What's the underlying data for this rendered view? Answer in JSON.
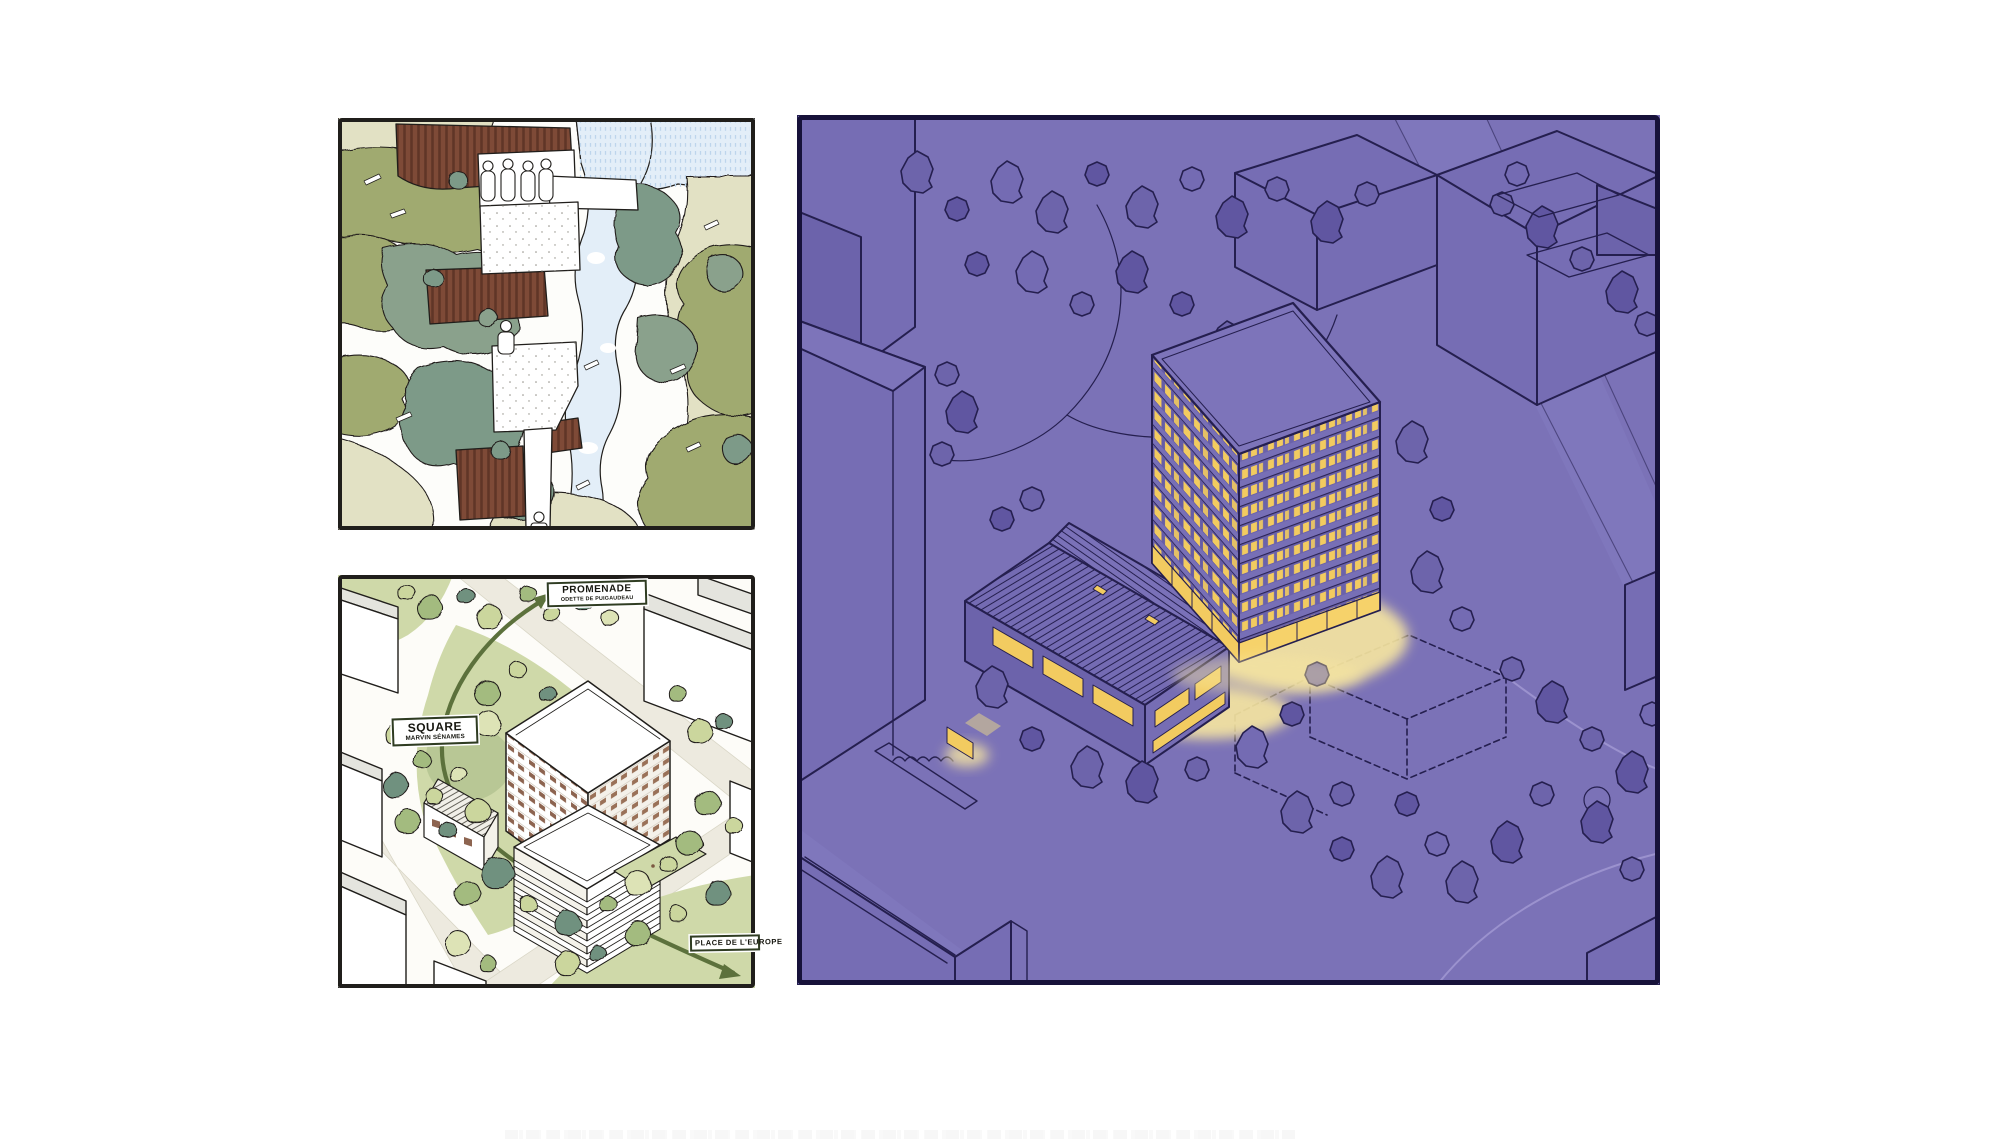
{
  "page": {
    "background": "#ffffff"
  },
  "site_axonometric": {
    "labels": {
      "promenade": {
        "title": "PROMENADE",
        "subtitle": "ODETTE DE PUIGAUDEAU"
      },
      "square": {
        "title": "SQUARE",
        "subtitle": "MARVIN SÉNAMES"
      },
      "place_de_europe": {
        "title": "PLACE DE L'EUROPE"
      }
    },
    "icons": [
      "route-arrow-icon"
    ]
  },
  "night_axonometric": {
    "highlight": "lit tower and gabled hall with window glow",
    "icons": [
      "dashed-future-volume"
    ]
  },
  "palette": {
    "page-bg": "#ffffff",
    "ink": "#201e1b",
    "night-ink": "#251f4f",
    "night-bg": "#7b72b7",
    "night-street": "#847bc1",
    "night-building": "#766db4",
    "night-building-dark": "#6c63ab",
    "night-roof": "#7d74ba",
    "night-tree": "#6d64ab",
    "night-tree-dark": "#6056a1",
    "window-lit": "#f2cb60",
    "window-glow": "#f8e7a0",
    "day-olive": "#a0aa70",
    "day-sage": "#8aa18c",
    "day-teal": "#7d9a88",
    "day-beige": "#e2e1c4",
    "day-blue": "#e3eef8",
    "day-blue-hatch": "#bdd5ec",
    "roof-brown": "#7e4a37",
    "roof-brown-dark": "#603527",
    "lawn": "#cfd9a9",
    "lawn-dark": "#b8c795",
    "tree-green": "#a3bb7f",
    "tree-green-light": "#cbd69d",
    "tree-green-dark": "#6f917f",
    "tree-green-pale": "#dde3b6",
    "street-cream": "#edeadf",
    "building-grey": "#e4e4de",
    "tower-band": "#8d6450",
    "arrow-green": "#5c713c",
    "label-border": "#2f3c22"
  }
}
